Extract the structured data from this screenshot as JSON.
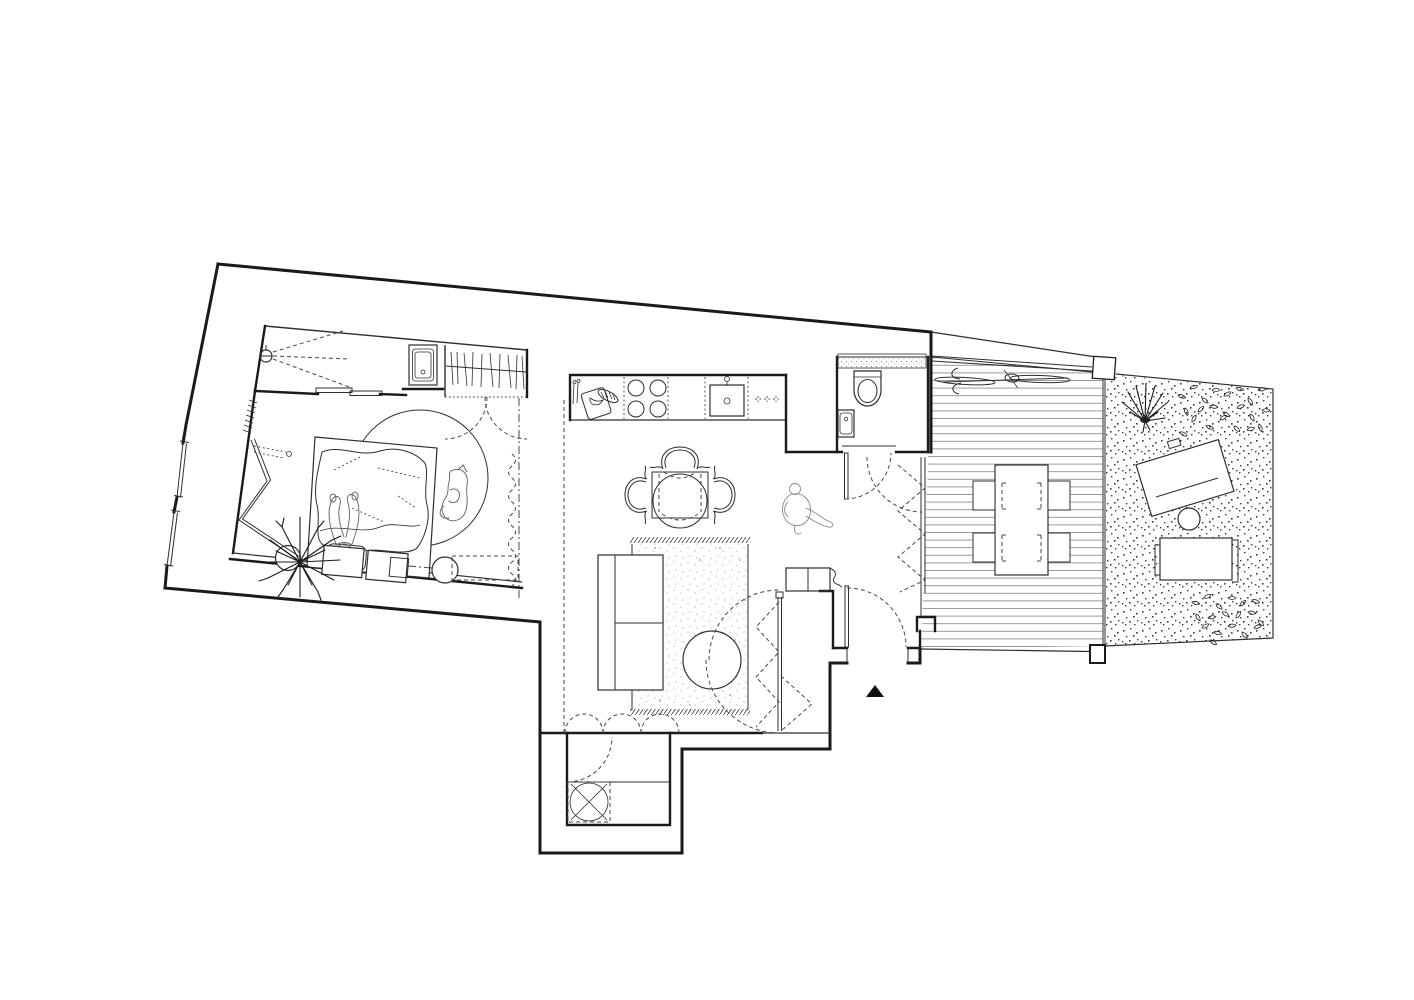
{
  "canvas": {
    "width": 1414,
    "height": 1000,
    "background": "#ffffff"
  },
  "palette": {
    "paper": "#ffffff",
    "ink": "#1a1a1a",
    "line": "#2e2e2e",
    "dash": "#474747",
    "sketch": "#5f5f5f",
    "sketch2": "#8a8a8a",
    "plank": "#8f8f8f",
    "stipple": "#3a3a3a",
    "rug_dot": "#c2c2c2",
    "marker": "#111111"
  },
  "drawing": {
    "type": "architectural-floor-plan",
    "view": "top-down",
    "style": "black line drawing on white, no text labels",
    "rooms": [
      "bedroom",
      "shower-room",
      "wardrobe",
      "kitchen",
      "dining-area",
      "living-room",
      "bathroom",
      "entry-vestibule",
      "laundry-alcove",
      "wood-deck",
      "gravel-garden"
    ],
    "furniture": [
      "double-bed",
      "sleeping-person",
      "curled-dog",
      "round-rug",
      "bedside-tables",
      "stool-circles",
      "folding-screen",
      "indoor-plant",
      "shower-head",
      "bedroom-washbasin",
      "hanging-clothes-rail",
      "kitchen-counter",
      "four-burner-cooktop",
      "kitchen-sink",
      "cutting-board-with-knives",
      "square-dining-table",
      "three-armchairs",
      "round-chair",
      "standing-person",
      "sofa",
      "fringed-area-rug",
      "round-coffee-table",
      "washing-machine-dashed",
      "toilet",
      "bathroom-washbasin",
      "hinged-entry-door",
      "accordion-folding-doors",
      "bicycle-top-view",
      "outdoor-dining-table",
      "four-outdoor-chairs",
      "sun-lounger-rotated",
      "sun-lounger-straight",
      "garden-grass-tuft",
      "scattered-leaves",
      "gate-post"
    ],
    "symbols": [
      "door-swing-arcs",
      "sliding-door-panels",
      "dashed-room-boundaries",
      "entry-direction-triangle"
    ]
  }
}
